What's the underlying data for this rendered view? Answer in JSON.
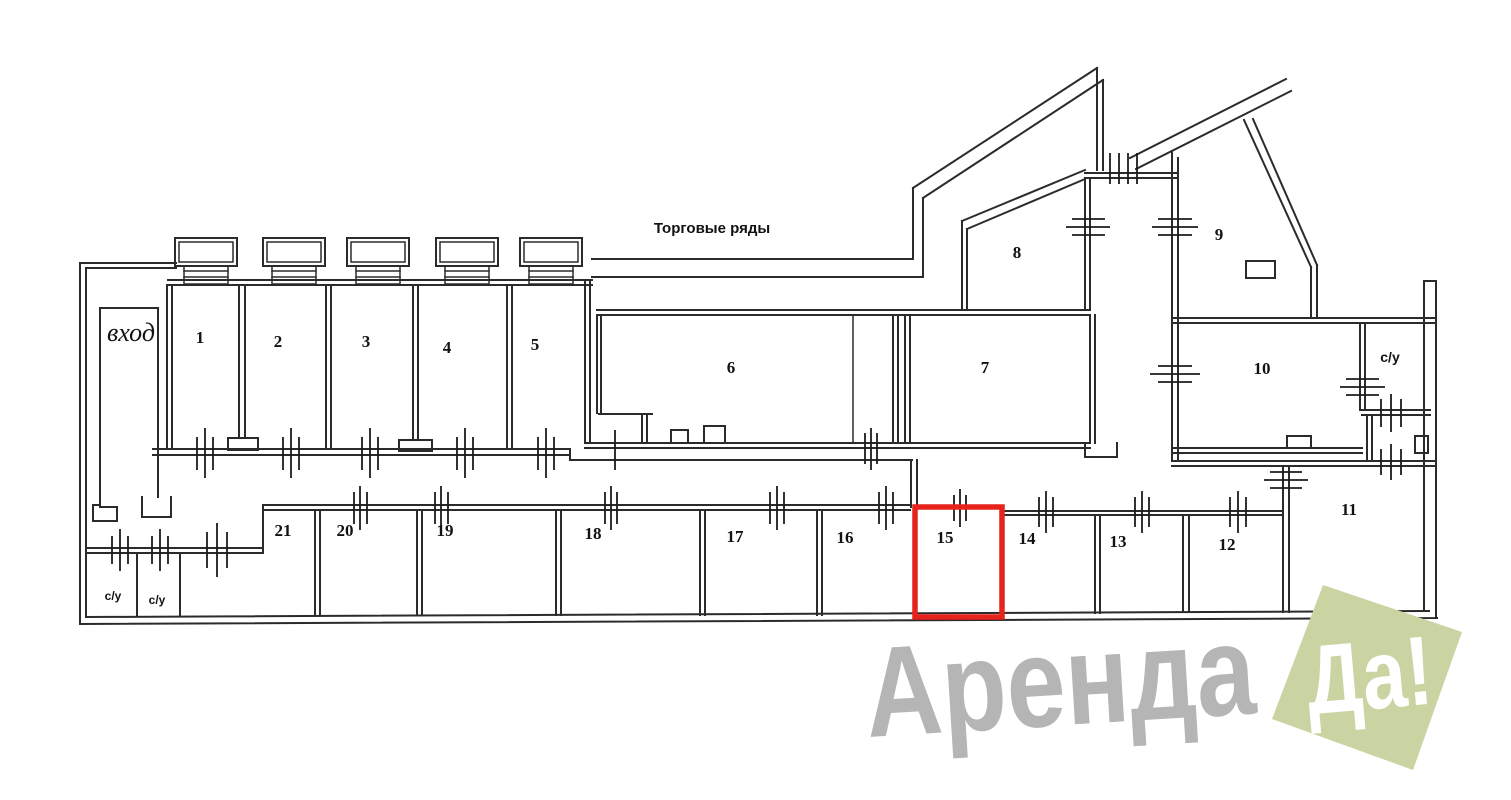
{
  "plan": {
    "area_label": "Торговые ряды",
    "entrance_label": "вход",
    "wc_labels": [
      "с/у",
      "с/у",
      "с/у"
    ],
    "rooms": [
      {
        "number": "1"
      },
      {
        "number": "2"
      },
      {
        "number": "3"
      },
      {
        "number": "4"
      },
      {
        "number": "5"
      },
      {
        "number": "6"
      },
      {
        "number": "7"
      },
      {
        "number": "8"
      },
      {
        "number": "9"
      },
      {
        "number": "10"
      },
      {
        "number": "11"
      },
      {
        "number": "12"
      },
      {
        "number": "13"
      },
      {
        "number": "14"
      },
      {
        "number": "15"
      },
      {
        "number": "16"
      },
      {
        "number": "17"
      },
      {
        "number": "18"
      },
      {
        "number": "19"
      },
      {
        "number": "20"
      },
      {
        "number": "21"
      }
    ],
    "highlight": {
      "room": "15",
      "color": "#e6231c"
    },
    "wall_color": "#2b2b2b"
  },
  "watermark": {
    "brand": "Аренда",
    "badge": "Да!",
    "brand_color": "#b5b5b5",
    "badge_color": "#c9d4a2",
    "badge_text_color": "#ffffff"
  }
}
